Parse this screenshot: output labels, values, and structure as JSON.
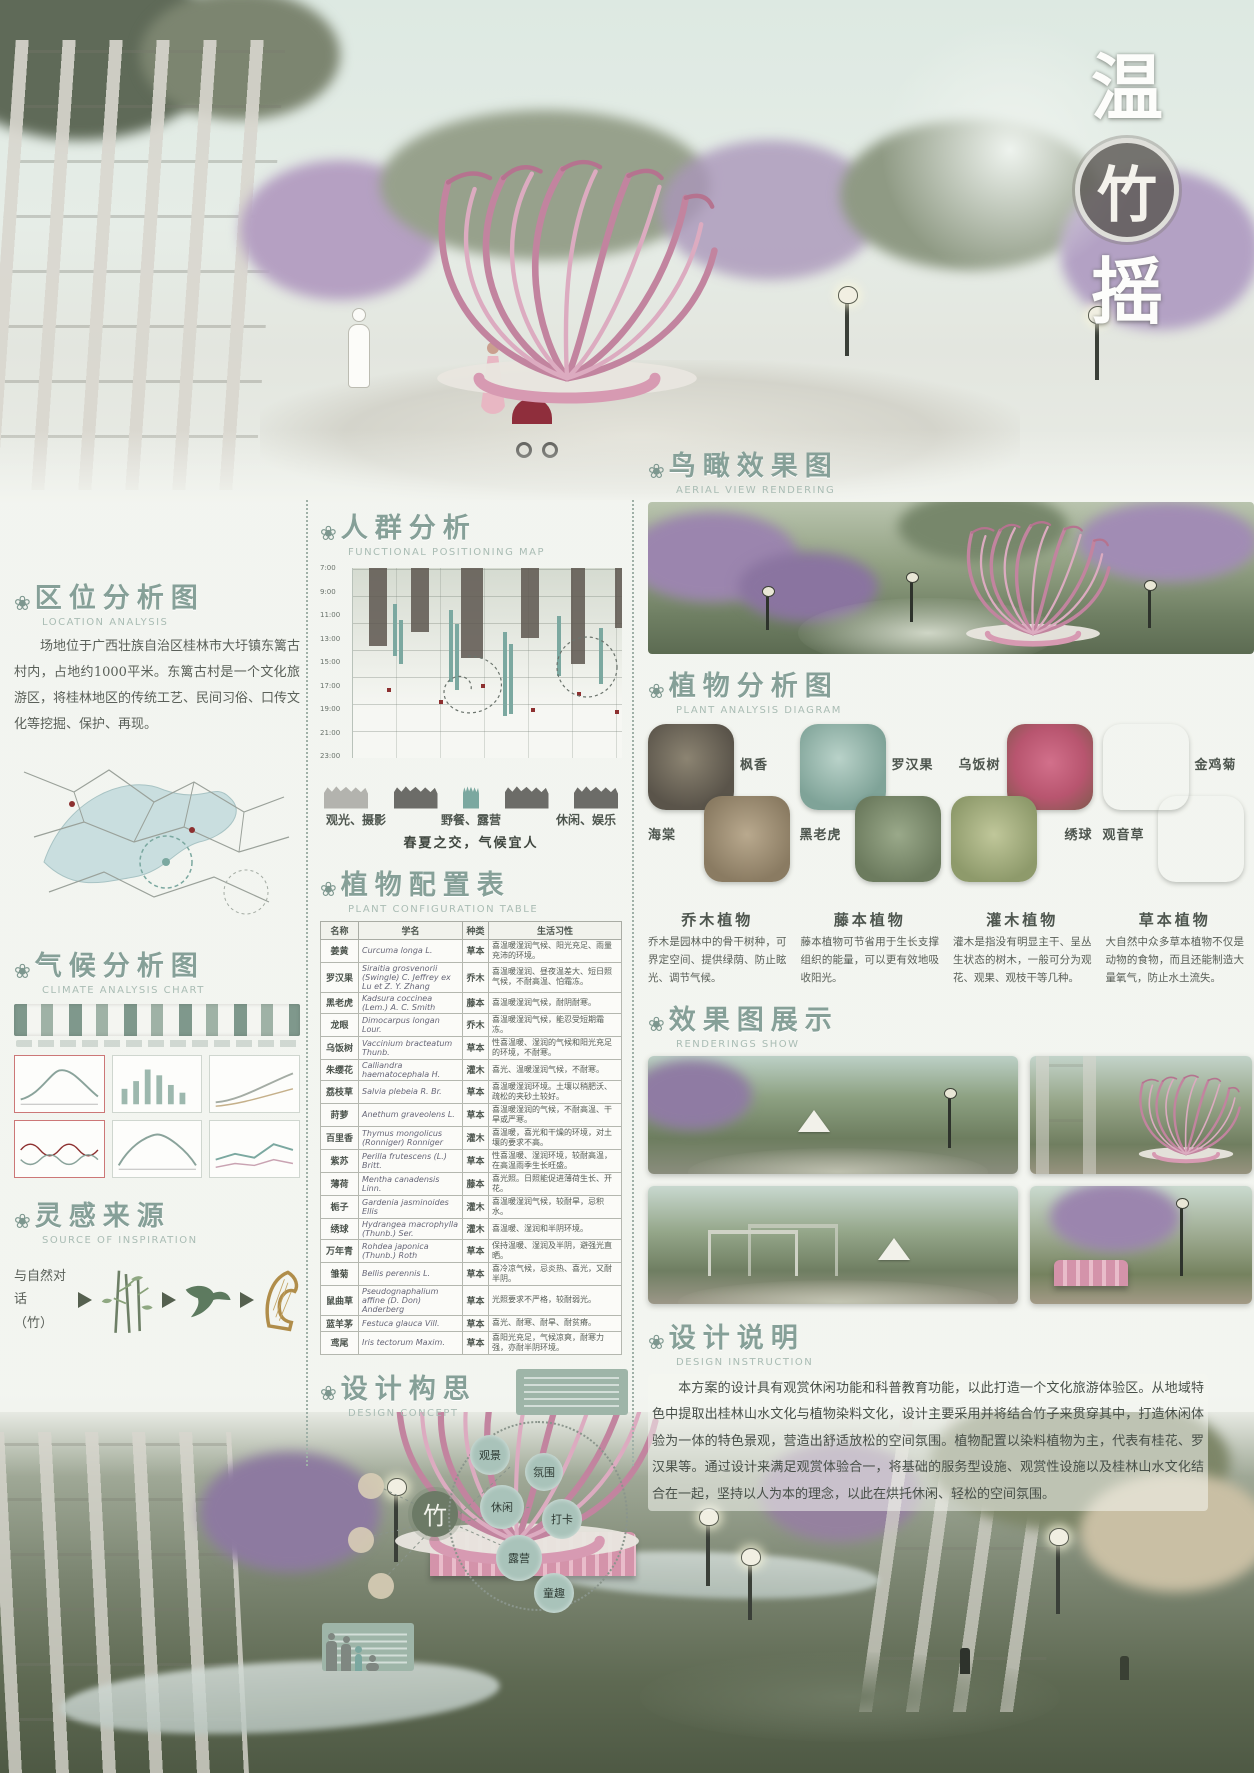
{
  "ui": {
    "section_icon": "❀"
  },
  "poster": {
    "title_top": "温",
    "title_seal": "竹",
    "title_bottom": "摇"
  },
  "sections": {
    "location": {
      "title": "区位分析图",
      "subtitle": "LOCATION ANALYSIS",
      "body": "场地位于广西壮族自治区桂林市大圩镇东篱古村内，占地约1000平米。东篱古村是一个文化旅游区，将桂林地区的传统工艺、民间习俗、口传文化等挖掘、保护、再现。"
    },
    "crowd": {
      "title": "人群分析",
      "subtitle": "FUNCTIONAL POSITIONING MAP",
      "time_labels": [
        "7:00",
        "9:00",
        "11:00",
        "13:00",
        "15:00",
        "17:00",
        "19:00",
        "21:00",
        "23:00"
      ],
      "activities": [
        "观光、摄影",
        "野餐、露营",
        "休闲、娱乐"
      ],
      "caption": "春夏之交，气候宜人"
    },
    "climate": {
      "title": "气候分析图",
      "subtitle": "CLIMATE ANALYSIS CHART"
    },
    "inspiration": {
      "title": "灵感来源",
      "subtitle": "SOURCE OF INSPIRATION",
      "note_line1": "与自然对话",
      "note_line2": "（竹）"
    },
    "plant_table": {
      "title": "植物配置表",
      "subtitle": "PLANT CONFIGURATION TABLE",
      "headers": {
        "name": "名称",
        "latin": "学名",
        "type": "种类",
        "habit": "生活习性"
      },
      "rows": [
        {
          "name": "姜黄",
          "latin": "Curcuma longa L.",
          "type": "草本",
          "habit": "喜温暖湿润气候、阳光充足、雨量充沛的环境。"
        },
        {
          "name": "罗汉果",
          "latin": "Siraitia grosvenorii (Swingle) C. Jeffrey ex Lu et Z. Y. Zhang",
          "type": "乔木",
          "habit": "喜温暖湿润、昼夜温差大、短日照气候，不耐高温、怕霜冻。"
        },
        {
          "name": "黑老虎",
          "latin": "Kadsura coccinea (Lem.) A. C. Smith",
          "type": "藤本",
          "habit": "喜温暖湿润气候，耐阴耐寒。"
        },
        {
          "name": "龙眼",
          "latin": "Dimocarpus longan Lour.",
          "type": "乔木",
          "habit": "喜温暖湿润气候，能忍受短期霜冻。"
        },
        {
          "name": "乌饭树",
          "latin": "Vaccinium bracteatum Thunb.",
          "type": "草本",
          "habit": "性喜温暖、湿润的气候和阳光充足的环境，不耐寒。"
        },
        {
          "name": "朱缨花",
          "latin": "Calliandra haematocephala H.",
          "type": "灌木",
          "habit": "喜光、温暖湿润气候，不耐寒。"
        },
        {
          "name": "荔枝草",
          "latin": "Salvia plebeia R. Br.",
          "type": "草本",
          "habit": "喜温暖湿润环境。土壤以稍肥沃、疏松的夹砂土较好。"
        },
        {
          "name": "莳萝",
          "latin": "Anethum graveolens L.",
          "type": "草本",
          "habit": "喜温暖湿润的气候，不耐高温、干旱或严寒。"
        },
        {
          "name": "百里香",
          "latin": "Thymus mongolicus (Ronniger) Ronniger",
          "type": "灌木",
          "habit": "喜温暖，喜光和干燥的环境，对土壤的要求不高。"
        },
        {
          "name": "紫苏",
          "latin": "Perilla frutescens (L.) Britt.",
          "type": "草本",
          "habit": "性喜温暖、湿润环境，较耐高温，在高温雨季生长旺盛。"
        },
        {
          "name": "薄荷",
          "latin": "Mentha canadensis Linn.",
          "type": "藤本",
          "habit": "喜光照。日照能促进薄荷生长、开花。"
        },
        {
          "name": "栀子",
          "latin": "Gardenia jasminoides Ellis",
          "type": "灌木",
          "habit": "喜温暖湿润气候，较耐旱，忌积水。"
        },
        {
          "name": "绣球",
          "latin": "Hydrangea macrophylla (Thunb.) Ser.",
          "type": "灌木",
          "habit": "喜温暖、湿润和半阴环境。"
        },
        {
          "name": "万年青",
          "latin": "Rohdea japonica (Thunb.) Roth",
          "type": "草本",
          "habit": "保持温暖、湿润及半阴，避强光直晒。"
        },
        {
          "name": "雏菊",
          "latin": "Bellis perennis L.",
          "type": "草本",
          "habit": "喜冷凉气候，忌炎热、喜光，又耐半阴。"
        },
        {
          "name": "鼠曲草",
          "latin": "Pseudognaphalium affine (D. Don) Anderberg",
          "type": "草本",
          "habit": "光照要求不严格，较耐弱光。"
        },
        {
          "name": "蓝羊茅",
          "latin": "Festuca glauca Vill.",
          "type": "草本",
          "habit": "喜光、耐寒、耐旱、耐贫瘠。"
        },
        {
          "name": "鸢尾",
          "latin": "Iris tectorum Maxim.",
          "type": "草本",
          "habit": "喜阳光充足，气候凉爽，耐寒力强，亦耐半阴环境。"
        }
      ]
    },
    "concept": {
      "title": "设计构思",
      "subtitle": "DESIGN CONCEPT",
      "center": "竹",
      "bubbles": [
        "观景",
        "氛围",
        "休闲",
        "打卡",
        "露营",
        "童趣"
      ]
    },
    "aerial": {
      "title": "鸟瞰效果图",
      "subtitle": "AERIAL VIEW RENDERING"
    },
    "plant_analysis": {
      "title": "植物分析图",
      "subtitle": "PLANT ANALYSIS DIAGRAM",
      "groups": [
        {
          "top": "枫香",
          "bottom": "海棠"
        },
        {
          "top": "罗汉果",
          "bottom": "黑老虎"
        },
        {
          "top": "乌饭树",
          "bottom": "绣球"
        },
        {
          "top": "金鸡菊",
          "bottom": "观音草"
        }
      ],
      "categories": [
        {
          "name": "乔木植物",
          "desc": "乔木是园林中的骨干树种，可界定空间、提供绿荫、防止眩光、调节气候。"
        },
        {
          "name": "藤本植物",
          "desc": "藤本植物可节省用于生长支撑组织的能量，可以更有效地吸收阳光。"
        },
        {
          "name": "灌木植物",
          "desc": "灌木是指没有明显主干、呈丛生状态的树木，一般可分为观花、观果、观枝干等几种。"
        },
        {
          "name": "草本植物",
          "desc": "大自然中众多草本植物不仅是动物的食物，而且还能制造大量氧气，防止水土流失。"
        }
      ]
    },
    "renderings": {
      "title": "效果图展示",
      "subtitle": "RENDERINGS SHOW"
    },
    "instruction": {
      "title": "设计说明",
      "subtitle": "DESIGN INSTRUCTION",
      "body": "本方案的设计具有观赏休闲功能和科普教育功能，以此打造一个文化旅游体验区。从地域特色中提取出桂林山水文化与植物染料文化，设计主要采用并将结合竹子来贯穿其中，打造休闲体验为一体的特色景观，营造出舒适放松的空间氛围。植物配置以染料植物为主，代表有桂花、罗汉果等。通过设计来满足观赏体验合一，将基础的服务型设施、观赏性设施以及桂林山水文化结合在一起，坚持以人为本的理念，以此在烘托休闲、轻松的空间氛围。"
    }
  }
}
